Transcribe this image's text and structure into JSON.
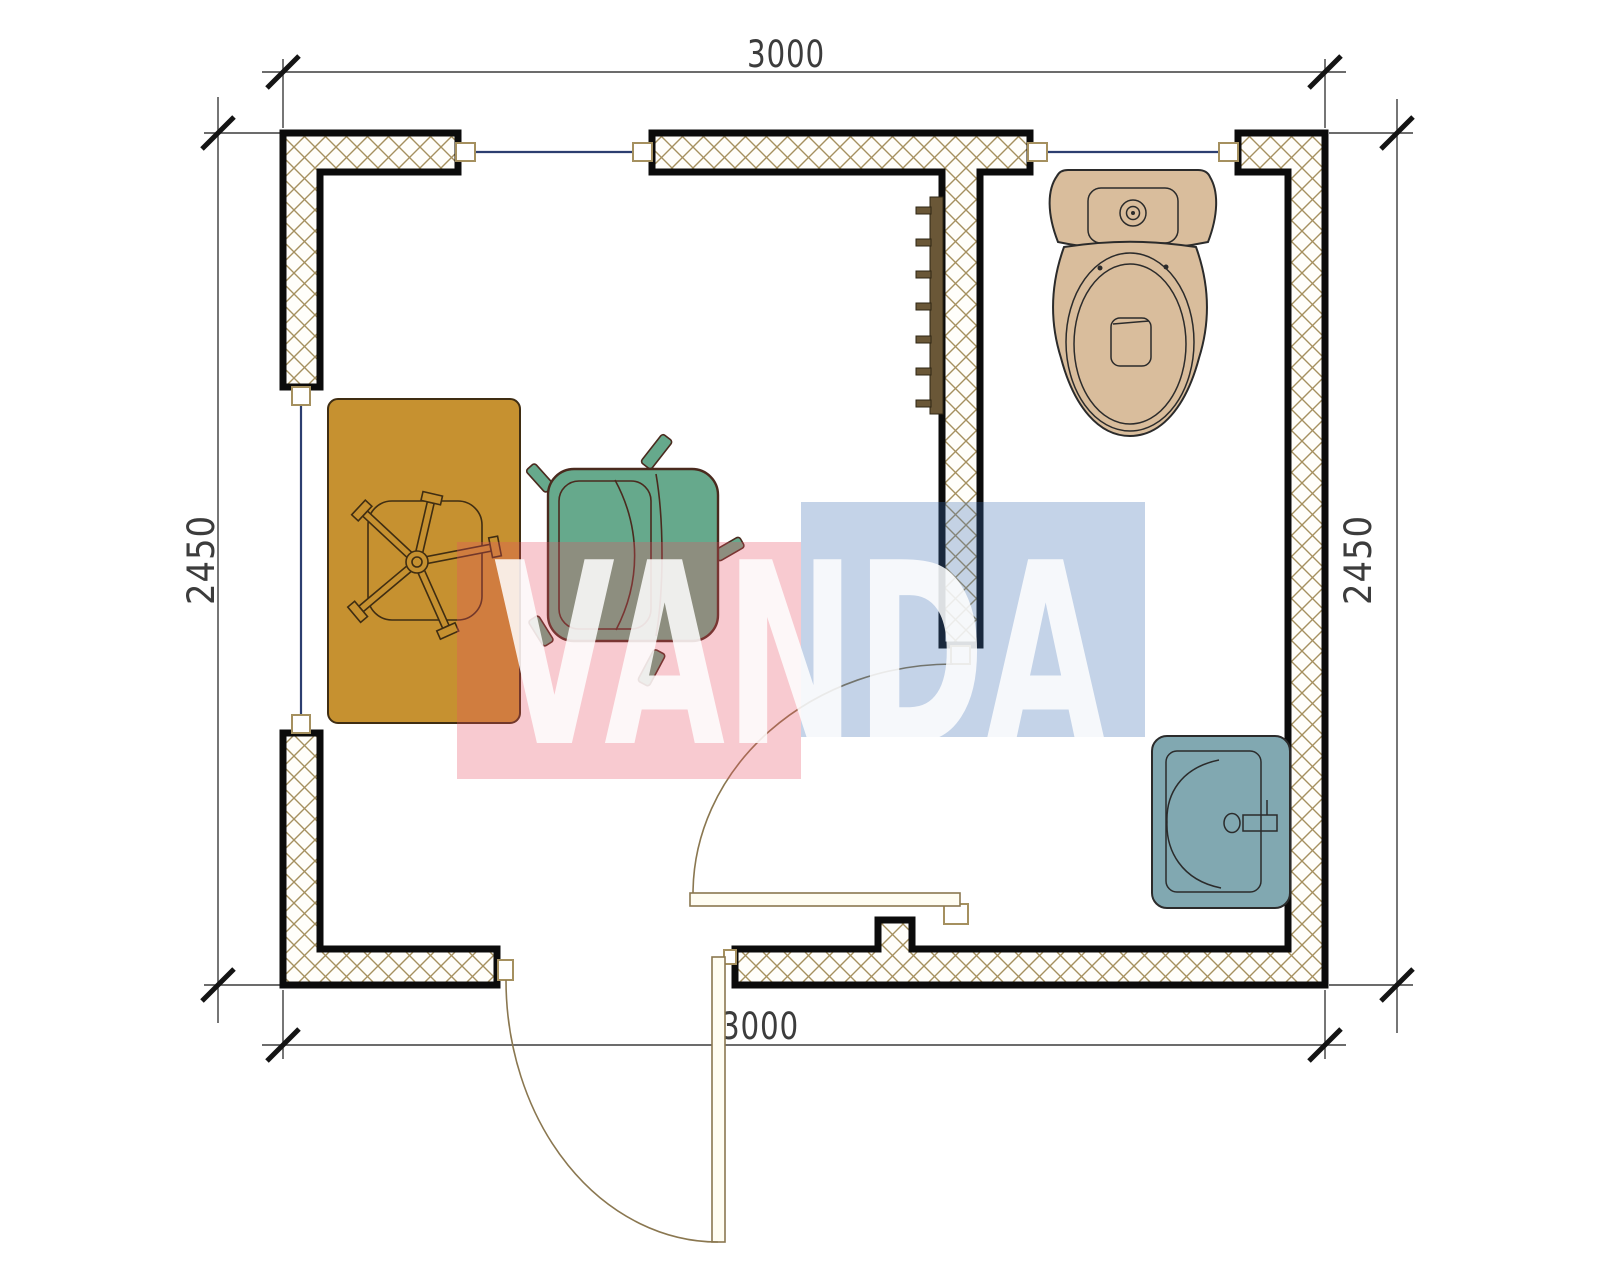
{
  "dimensions": {
    "top": "3000",
    "bottom": "3000",
    "left": "2450",
    "right": "2450"
  },
  "watermark": {
    "text": "VANDA"
  },
  "colors": {
    "wall_outline": "#0b0b0b",
    "hatch_line": "#a5905f",
    "window_line": "#2c3e70",
    "jamb_stroke": "#a5905f",
    "dim": "#3c3c3c",
    "tick": "#141414",
    "desk": "#c69130",
    "desk_outline": "#3f2d12",
    "armchair": "#66a98c",
    "armchair_outline": "#4a2a1e",
    "toilet": "#d9bd9c",
    "sink": "#81a8b1",
    "fixture_outline": "#2b2b2b",
    "radiator": "#6a5737",
    "door": "#8a7750",
    "door_leaf_fill": "#fffdf2",
    "wm_pink": "rgba(232,80,100,0.30)",
    "wm_blue": "rgba(60,110,180,0.30)",
    "wm_text": "#ffffff"
  }
}
